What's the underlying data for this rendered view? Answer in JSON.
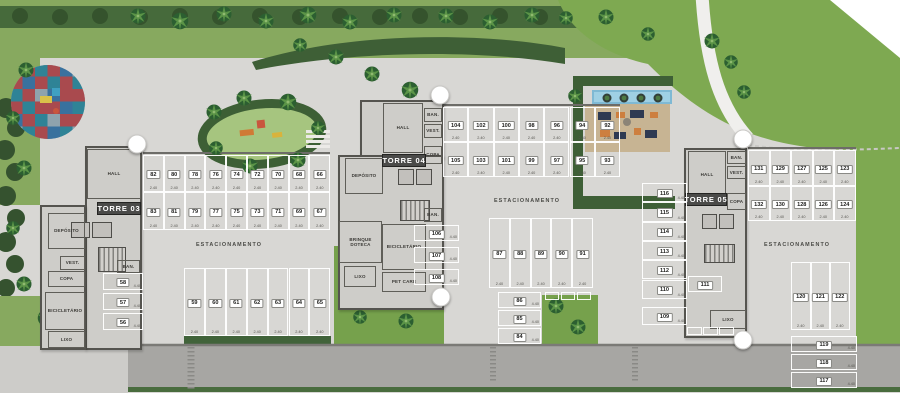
{
  "plan": {
    "estacionamento_labels": [
      {
        "text": "ESTACIONAMENTO",
        "x": 229,
        "y": 245
      },
      {
        "text": "ESTACIONAMENTO",
        "x": 527,
        "y": 201
      },
      {
        "text": "ESTACIONAMENTO",
        "x": 797,
        "y": 245
      }
    ],
    "towers": [
      {
        "id": "torre-03",
        "label": "TORRE 03",
        "label_box": {
          "x": 97,
          "y": 202,
          "w": 42,
          "h": 11
        },
        "footprint": [
          {
            "x": 85,
            "y": 146,
            "w": 57,
            "h": 204
          },
          {
            "x": 40,
            "y": 205,
            "w": 46,
            "h": 145
          }
        ],
        "rooms": [
          {
            "label": "HALL",
            "x": 87,
            "y": 149,
            "w": 54,
            "h": 50
          },
          {
            "label": "DEPÓSITO",
            "x": 48,
            "y": 213,
            "w": 37,
            "h": 36
          },
          {
            "label": "VEST.",
            "x": 60,
            "y": 256,
            "w": 25,
            "h": 14
          },
          {
            "label": "COPA",
            "x": 48,
            "y": 271,
            "w": 37,
            "h": 16
          },
          {
            "label": "BICICLETÁRIO",
            "x": 45,
            "y": 292,
            "w": 40,
            "h": 38
          },
          {
            "label": "LIXO",
            "x": 48,
            "y": 331,
            "w": 37,
            "h": 17
          },
          {
            "label": "BAN.",
            "x": 117,
            "y": 260,
            "w": 23,
            "h": 13
          }
        ],
        "features": [
          {
            "type": "elevator",
            "x": 71,
            "y": 222,
            "w": 19,
            "h": 16
          },
          {
            "type": "elevator",
            "x": 92,
            "y": 222,
            "w": 20,
            "h": 16
          },
          {
            "type": "stairs",
            "x": 98,
            "y": 247,
            "w": 28,
            "h": 25
          }
        ]
      },
      {
        "id": "torre-04",
        "label": "TORRE 04",
        "label_box": {
          "x": 382,
          "y": 154,
          "w": 42,
          "h": 11
        },
        "footprint": [
          {
            "x": 360,
            "y": 100,
            "w": 84,
            "h": 58
          },
          {
            "x": 338,
            "y": 155,
            "w": 106,
            "h": 155
          }
        ],
        "rooms": [
          {
            "label": "HALL",
            "x": 383,
            "y": 103,
            "w": 40,
            "h": 50
          },
          {
            "label": "BAN.",
            "x": 424,
            "y": 108,
            "w": 18,
            "h": 14
          },
          {
            "label": "VEST.",
            "x": 424,
            "y": 124,
            "w": 18,
            "h": 14
          },
          {
            "label": "COPA",
            "x": 424,
            "y": 146,
            "w": 18,
            "h": 18
          },
          {
            "label": "DEPÓSITO",
            "x": 345,
            "y": 158,
            "w": 38,
            "h": 36
          },
          {
            "label": "BAN.",
            "x": 424,
            "y": 208,
            "w": 18,
            "h": 14
          },
          {
            "label": "BRINQUE DOTECA",
            "x": 339,
            "y": 221,
            "w": 43,
            "h": 42
          },
          {
            "label": "BICICLETÁRIO",
            "x": 382,
            "y": 224,
            "w": 44,
            "h": 46
          },
          {
            "label": "LIXO",
            "x": 344,
            "y": 266,
            "w": 32,
            "h": 21
          },
          {
            "label": "PET CARE",
            "x": 382,
            "y": 272,
            "w": 44,
            "h": 20
          }
        ],
        "features": [
          {
            "type": "elevator",
            "x": 398,
            "y": 169,
            "w": 16,
            "h": 16
          },
          {
            "type": "elevator",
            "x": 416,
            "y": 169,
            "w": 16,
            "h": 16
          },
          {
            "type": "stairs",
            "x": 400,
            "y": 200,
            "w": 30,
            "h": 21
          }
        ]
      },
      {
        "id": "torre-05",
        "label": "TORRE 05",
        "label_box": {
          "x": 685,
          "y": 193,
          "w": 40,
          "h": 11
        },
        "footprint": [
          {
            "x": 684,
            "y": 148,
            "w": 63,
            "h": 190
          }
        ],
        "rooms": [
          {
            "label": "HALL",
            "x": 688,
            "y": 151,
            "w": 38,
            "h": 48
          },
          {
            "label": "BAN.",
            "x": 727,
            "y": 151,
            "w": 19,
            "h": 13
          },
          {
            "label": "VEST.",
            "x": 727,
            "y": 166,
            "w": 19,
            "h": 13
          },
          {
            "label": "COPA",
            "x": 727,
            "y": 193,
            "w": 19,
            "h": 17
          },
          {
            "label": "LIXO",
            "x": 710,
            "y": 310,
            "w": 36,
            "h": 19
          }
        ],
        "features": [
          {
            "type": "elevator",
            "x": 702,
            "y": 214,
            "w": 15,
            "h": 15
          },
          {
            "type": "elevator",
            "x": 719,
            "y": 214,
            "w": 15,
            "h": 15
          },
          {
            "type": "stairs",
            "x": 704,
            "y": 244,
            "w": 31,
            "h": 19
          }
        ]
      }
    ],
    "parking_groups": [
      {
        "id": "t03-row-a",
        "dir": "row",
        "x": 143,
        "y": 155,
        "cell_w": 20.8,
        "cell_h": 37,
        "gap": 0,
        "numbers": [
          "82",
          "80",
          "78",
          "76",
          "74",
          "72",
          "70",
          "68",
          "66"
        ],
        "dim": "2.40"
      },
      {
        "id": "t03-row-b",
        "dir": "row",
        "x": 143,
        "y": 192,
        "cell_w": 20.8,
        "cell_h": 38,
        "gap": 0,
        "numbers": [
          "83",
          "81",
          "79",
          "77",
          "75",
          "73",
          "71",
          "69",
          "67"
        ],
        "dim": "2.40"
      },
      {
        "id": "t03-row-c",
        "dir": "row",
        "x": 184,
        "y": 268,
        "cell_w": 20.9,
        "cell_h": 68,
        "gap": 0,
        "numbers": [
          "59",
          "60",
          "61",
          "62",
          "63",
          "64",
          "65"
        ],
        "dim": "2.40"
      },
      {
        "id": "t03-stack",
        "dir": "stack",
        "x": 103,
        "y": 273,
        "cell_w": 40,
        "cell_h": 17,
        "gap": 3,
        "numbers": [
          "58",
          "57",
          "56"
        ],
        "dim": "4.40"
      },
      {
        "id": "t04-row-a",
        "dir": "row",
        "x": 443,
        "y": 107,
        "cell_w": 25.3,
        "cell_h": 35,
        "gap": 0,
        "numbers": [
          "104",
          "102",
          "100",
          "98",
          "96",
          "94",
          "92"
        ],
        "dim": "2.40"
      },
      {
        "id": "t04-row-b",
        "dir": "row",
        "x": 443,
        "y": 142,
        "cell_w": 25.3,
        "cell_h": 35,
        "gap": 0,
        "numbers": [
          "105",
          "103",
          "101",
          "99",
          "97",
          "95",
          "93"
        ],
        "dim": "2.40"
      },
      {
        "id": "t04-row-c",
        "dir": "row",
        "x": 489,
        "y": 218,
        "cell_w": 20.8,
        "cell_h": 70,
        "gap": 0,
        "numbers": [
          "87",
          "88",
          "89",
          "90",
          "91"
        ],
        "dim": "2.40"
      },
      {
        "id": "t04-stack",
        "dir": "stack",
        "x": 498,
        "y": 292,
        "cell_w": 43,
        "cell_h": 16,
        "gap": 2,
        "numbers": [
          "86",
          "85",
          "84"
        ],
        "dim": "4.40"
      },
      {
        "id": "t04-moto",
        "dir": "row",
        "x": 545,
        "y": 292,
        "cell_w": 14,
        "cell_h": 8,
        "gap": 2,
        "numbers": [
          "",
          "",
          ""
        ]
      },
      {
        "id": "t04-stack-b",
        "dir": "stack",
        "x": 414,
        "y": 225,
        "cell_w": 45,
        "cell_h": 16,
        "gap": 6,
        "numbers": [
          "106",
          "107",
          "108"
        ],
        "dim": "4.40"
      },
      {
        "id": "t05-col",
        "dir": "stack",
        "x": 642,
        "y": 183,
        "cell_w": 45,
        "cell_h": 19.3,
        "gap": 0,
        "numbers": [
          "116",
          "115",
          "114",
          "113",
          "112",
          "110"
        ],
        "dim": "4.40"
      },
      {
        "id": "t05-109",
        "dir": "stack",
        "x": 642,
        "y": 307,
        "cell_w": 45,
        "cell_h": 18,
        "gap": 0,
        "numbers": [
          "109"
        ],
        "dim": "4.40"
      },
      {
        "id": "t05-111",
        "dir": "stack",
        "x": 688,
        "y": 276,
        "cell_w": 34,
        "cell_h": 16,
        "gap": 0,
        "numbers": [
          "111"
        ]
      },
      {
        "id": "t05-row-a",
        "dir": "row",
        "x": 748,
        "y": 150,
        "cell_w": 21.5,
        "cell_h": 36,
        "gap": 0,
        "numbers": [
          "131",
          "129",
          "127",
          "125",
          "123"
        ],
        "dim": "2.40"
      },
      {
        "id": "t05-row-b",
        "dir": "row",
        "x": 748,
        "y": 186,
        "cell_w": 21.5,
        "cell_h": 35,
        "gap": 0,
        "numbers": [
          "132",
          "130",
          "128",
          "126",
          "124"
        ],
        "dim": "2.40"
      },
      {
        "id": "t05-row-c",
        "dir": "row",
        "x": 791,
        "y": 262,
        "cell_w": 19.5,
        "cell_h": 68,
        "gap": 0,
        "numbers": [
          "120",
          "121",
          "122"
        ],
        "dim": "2.40"
      },
      {
        "id": "t05-stack",
        "dir": "stack",
        "x": 791,
        "y": 336,
        "cell_w": 66,
        "cell_h": 16,
        "gap": 2,
        "numbers": [
          "119",
          "118",
          "117"
        ],
        "dim": "4.40"
      },
      {
        "id": "t05-moto",
        "dir": "row",
        "x": 687,
        "y": 327,
        "cell_w": 15,
        "cell_h": 8,
        "gap": 1,
        "numbers": [
          "",
          "",
          ""
        ]
      }
    ],
    "markers": [
      {
        "x": 137,
        "y": 144
      },
      {
        "x": 440,
        "y": 95
      },
      {
        "x": 743,
        "y": 139
      },
      {
        "x": 441,
        "y": 297
      },
      {
        "x": 743,
        "y": 340
      }
    ]
  },
  "colors": {
    "pavement": "#d8d7d4",
    "road": "#a7a6a3",
    "lawn": "#87a95f",
    "lawn_big": "#7ea951",
    "hedge": "#3e5f36",
    "building": "#cecdc9",
    "wall": "#55544f",
    "stall_line": "#ffffff",
    "tower_label_bg": "#4b4b49",
    "pool": "#7fb9d4",
    "deck": "#c7b493",
    "marker": "#ffffff"
  }
}
